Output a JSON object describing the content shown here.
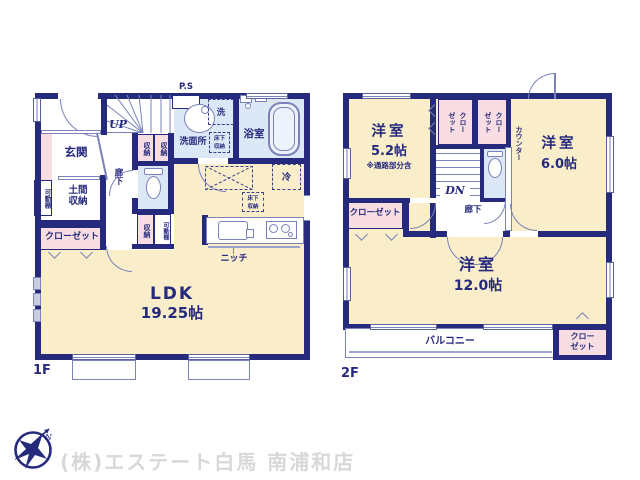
{
  "colors": {
    "wall": "#262a7d",
    "room_floor": "#f9edca",
    "closet_fill": "#f8dee2",
    "wet_area_fill": "#dde8f6",
    "watermark_text": "#d8d8d8"
  },
  "floor1": {
    "label": "1F",
    "pipe_space": "P.S",
    "stairs_up": "UP",
    "entrance": "玄関",
    "doma_storage": "土間\n収納",
    "movable_shelf": "可動棚",
    "closet": "クローゼット",
    "storage": "収納",
    "hallway": "廊下",
    "washroom": "洗面所",
    "washer": "洗",
    "underfloor_storage": "床下\n収納",
    "bathroom": "浴室",
    "fridge": "冷",
    "niche": "ニッチ",
    "ldk": {
      "name": "LDK",
      "size": "19.25帖"
    }
  },
  "floor2": {
    "label": "2F",
    "stairs_down": "DN",
    "hallway": "廊下",
    "counter": "カウンター",
    "closet": "クローゼット",
    "closet_two_line": "クロー\nゼット",
    "room_5_2": {
      "name": "洋室",
      "size": "5.2帖",
      "note": "※通路部分含"
    },
    "room_6_0": {
      "name": "洋室",
      "size": "6.0帖"
    },
    "room_12_0": {
      "name": "洋室",
      "size": "12.0帖"
    },
    "balcony": "バルコニー"
  },
  "footer": {
    "company": "(株)エステート白馬 南浦和店"
  }
}
